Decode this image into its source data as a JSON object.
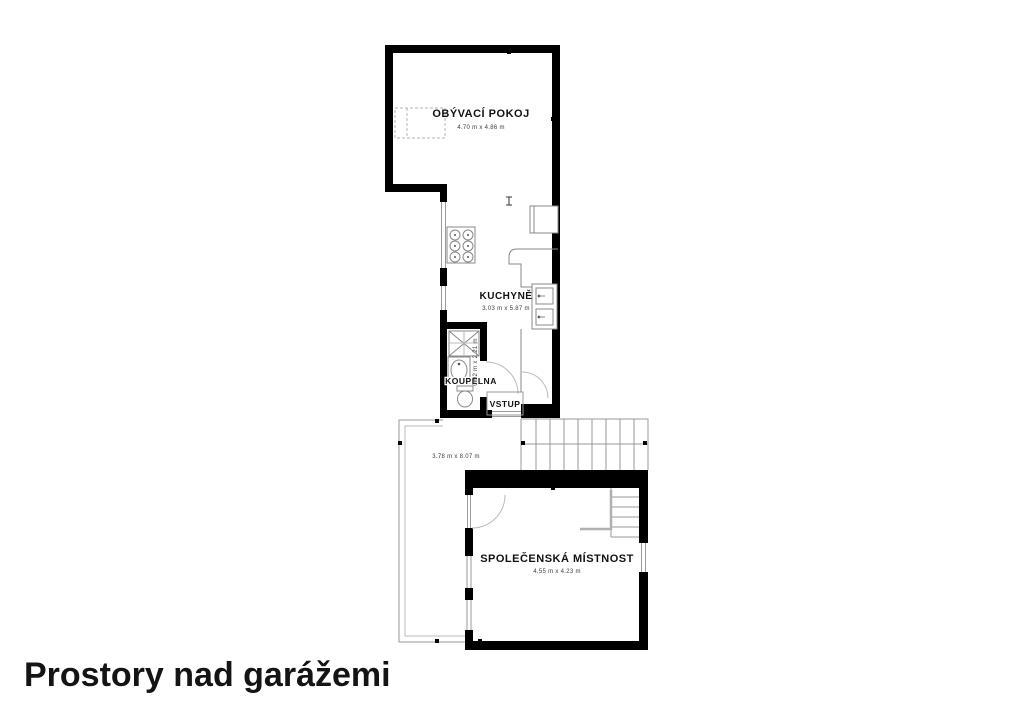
{
  "title": {
    "text": "Prostory nad garážemi"
  },
  "plan": {
    "rooms": {
      "living": {
        "label": "OBÝVACÍ POKOJ",
        "dims": "4.70 m x 4.86 m"
      },
      "kitchen": {
        "label": "KUCHYNĚ",
        "dims": "3.03 m x 5.87 m"
      },
      "bath": {
        "label": "KOUPELNA",
        "dims": "0.92 m x 2.21 m"
      },
      "entry": {
        "label": "VSTUP"
      },
      "common": {
        "label": "SPOLEČENSKÁ MÍSTNOST",
        "dims": "4.55 m x 4.23 m"
      },
      "terrace": {
        "dims": "3.78 m x 8.07 m"
      }
    },
    "colors": {
      "wall": "#000000",
      "thin_line": "#999999",
      "background": "#ffffff"
    }
  }
}
